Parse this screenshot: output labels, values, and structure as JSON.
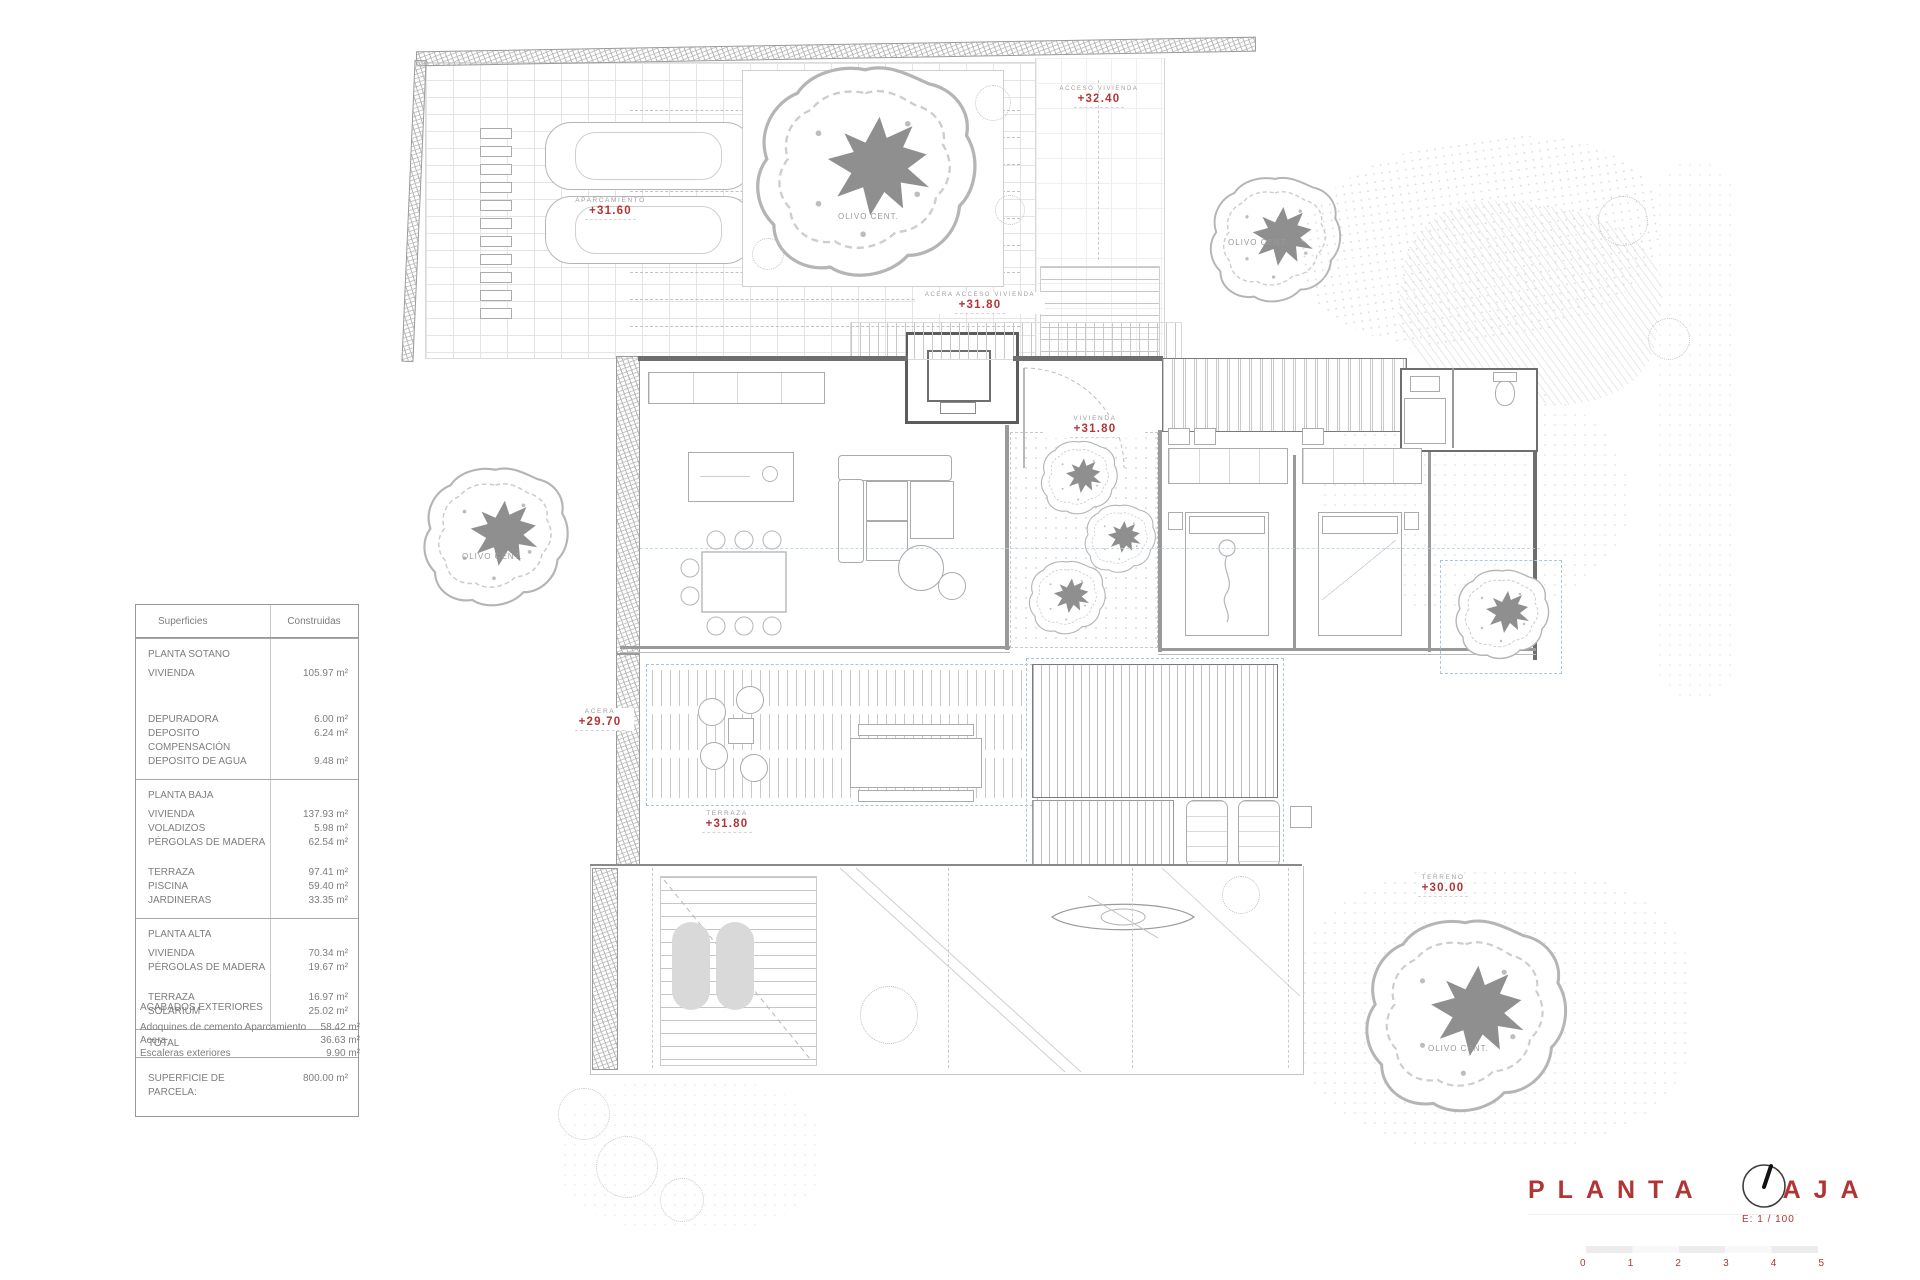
{
  "surface_table": {
    "headers": {
      "col1": "Superficies",
      "col2": "Construidas"
    },
    "sotano": {
      "title": "PLANTA SOTANO",
      "rows": [
        {
          "l": "VIVIENDA",
          "v": "105.97 m²"
        },
        {
          "l": "DEPURADORA",
          "v": "6.00 m²"
        },
        {
          "l": "DEPOSITO COMPENSACIÓN",
          "v": "6.24 m²"
        },
        {
          "l": "DEPOSITO DE AGUA",
          "v": "9.48 m²"
        }
      ]
    },
    "baja": {
      "title": "PLANTA BAJA",
      "rows": [
        {
          "l": "VIVIENDA",
          "v": "137.93 m²"
        },
        {
          "l": "VOLADIZOS",
          "v": "5.98 m²"
        },
        {
          "l": "PÉRGOLAS DE MADERA",
          "v": "62.54 m²"
        },
        {
          "l": "TERRAZA",
          "v": "97.41 m²"
        },
        {
          "l": "PISCINA",
          "v": "59.40 m²"
        },
        {
          "l": "JARDINERAS",
          "v": "33.35 m²"
        }
      ]
    },
    "alta": {
      "title": "PLANTA ALTA",
      "rows": [
        {
          "l": "VIVIENDA",
          "v": "70.34 m²"
        },
        {
          "l": "PÉRGOLAS DE MADERA",
          "v": "19.67 m²"
        },
        {
          "l": "TERRAZA",
          "v": "16.97 m²"
        },
        {
          "l": "SOLARIUM",
          "v": "25.02 m²"
        }
      ]
    },
    "total_label": "TOTAL",
    "parcela": {
      "l": "SUPERFICIE DE PARCELA:",
      "v": "800.00 m²"
    }
  },
  "acabados": {
    "title": "ACABADOS EXTERIORES",
    "rows": [
      {
        "l": "Adoquines de cemento Aparcamiento",
        "v": "58.42 m²"
      },
      {
        "l": "Acera",
        "v": "36.63 m²"
      },
      {
        "l": "Escaleras exteriores",
        "v": "9.90 m²"
      }
    ]
  },
  "plan_labels": {
    "aparcamiento": {
      "name": "APARCAMIENTO",
      "level": "+31.60"
    },
    "acceso": {
      "name": "ACCESO VIVIENDA",
      "level": "+32.40"
    },
    "acera_acceso": {
      "name": "ACERA ACCESO VIVIENDA",
      "level": "+31.80"
    },
    "vivienda": {
      "name": "VIVIENDA",
      "level": "+31.80"
    },
    "acera": {
      "name": "ACERA",
      "level": "+29.70"
    },
    "terraza": {
      "name": "TERRAZA",
      "level": "+31.80"
    },
    "terreno": {
      "name": "TERRENO",
      "level": "+30.00"
    },
    "olivo": "OLIVO CENT."
  },
  "titleblock": {
    "title_word1": "PLANTA",
    "title_word2": "BAJA",
    "scale": "E: 1 / 100",
    "scale_numbers": [
      "0",
      "1",
      "2",
      "3",
      "4",
      "5"
    ]
  },
  "colors": {
    "accent_red": "#b23434",
    "line_grey": "#9a9a9a",
    "blue_dash": "#a9c6de"
  }
}
